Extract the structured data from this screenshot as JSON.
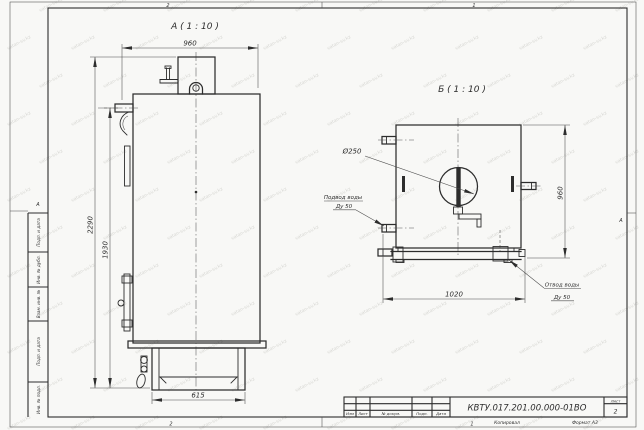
{
  "sheet": {
    "zone_numbers_top": [
      "2",
      "1"
    ],
    "zone_numbers_bottom": [
      "2",
      "1"
    ],
    "zone_letter_left": "А",
    "zone_letter_right": "А"
  },
  "views": {
    "a_label": "А ( 1 : 10 )",
    "b_label": "Б ( 1 : 10 )"
  },
  "dimensions": {
    "a_top_width": "960",
    "a_overall_height": "2290",
    "a_body_height": "1930",
    "a_base_width": "615",
    "b_width": "1020",
    "b_height": "960",
    "flue_diameter": "Ø250"
  },
  "callouts": {
    "inlet_title": "Подвод воды",
    "inlet_size": "Ду 50",
    "outlet_title": "Отвод воды",
    "outlet_size": "Ду 50"
  },
  "title_block": {
    "doc_number": "КВТУ.017.201.00.000-01ВО",
    "columns": [
      "Изм",
      "Лист",
      "№ докум.",
      "Подп.",
      "Дата"
    ],
    "sheet_label": "Лист",
    "sheet_number": "2",
    "copied_label": "Копировал",
    "format_label": "Формат А3"
  },
  "side_column": {
    "items": [
      "Подп. и дата",
      "Инв. № дубл.",
      "Взам. инв. №",
      "Подп. и дата",
      "Инв. № подл."
    ]
  },
  "watermark": {
    "text": "vatan-sv.kz",
    "color": "#d7d7d3"
  },
  "colors": {
    "line": "#2d2d2d",
    "thin_line": "#4a4a4a",
    "paper": "#f8f8f6"
  }
}
